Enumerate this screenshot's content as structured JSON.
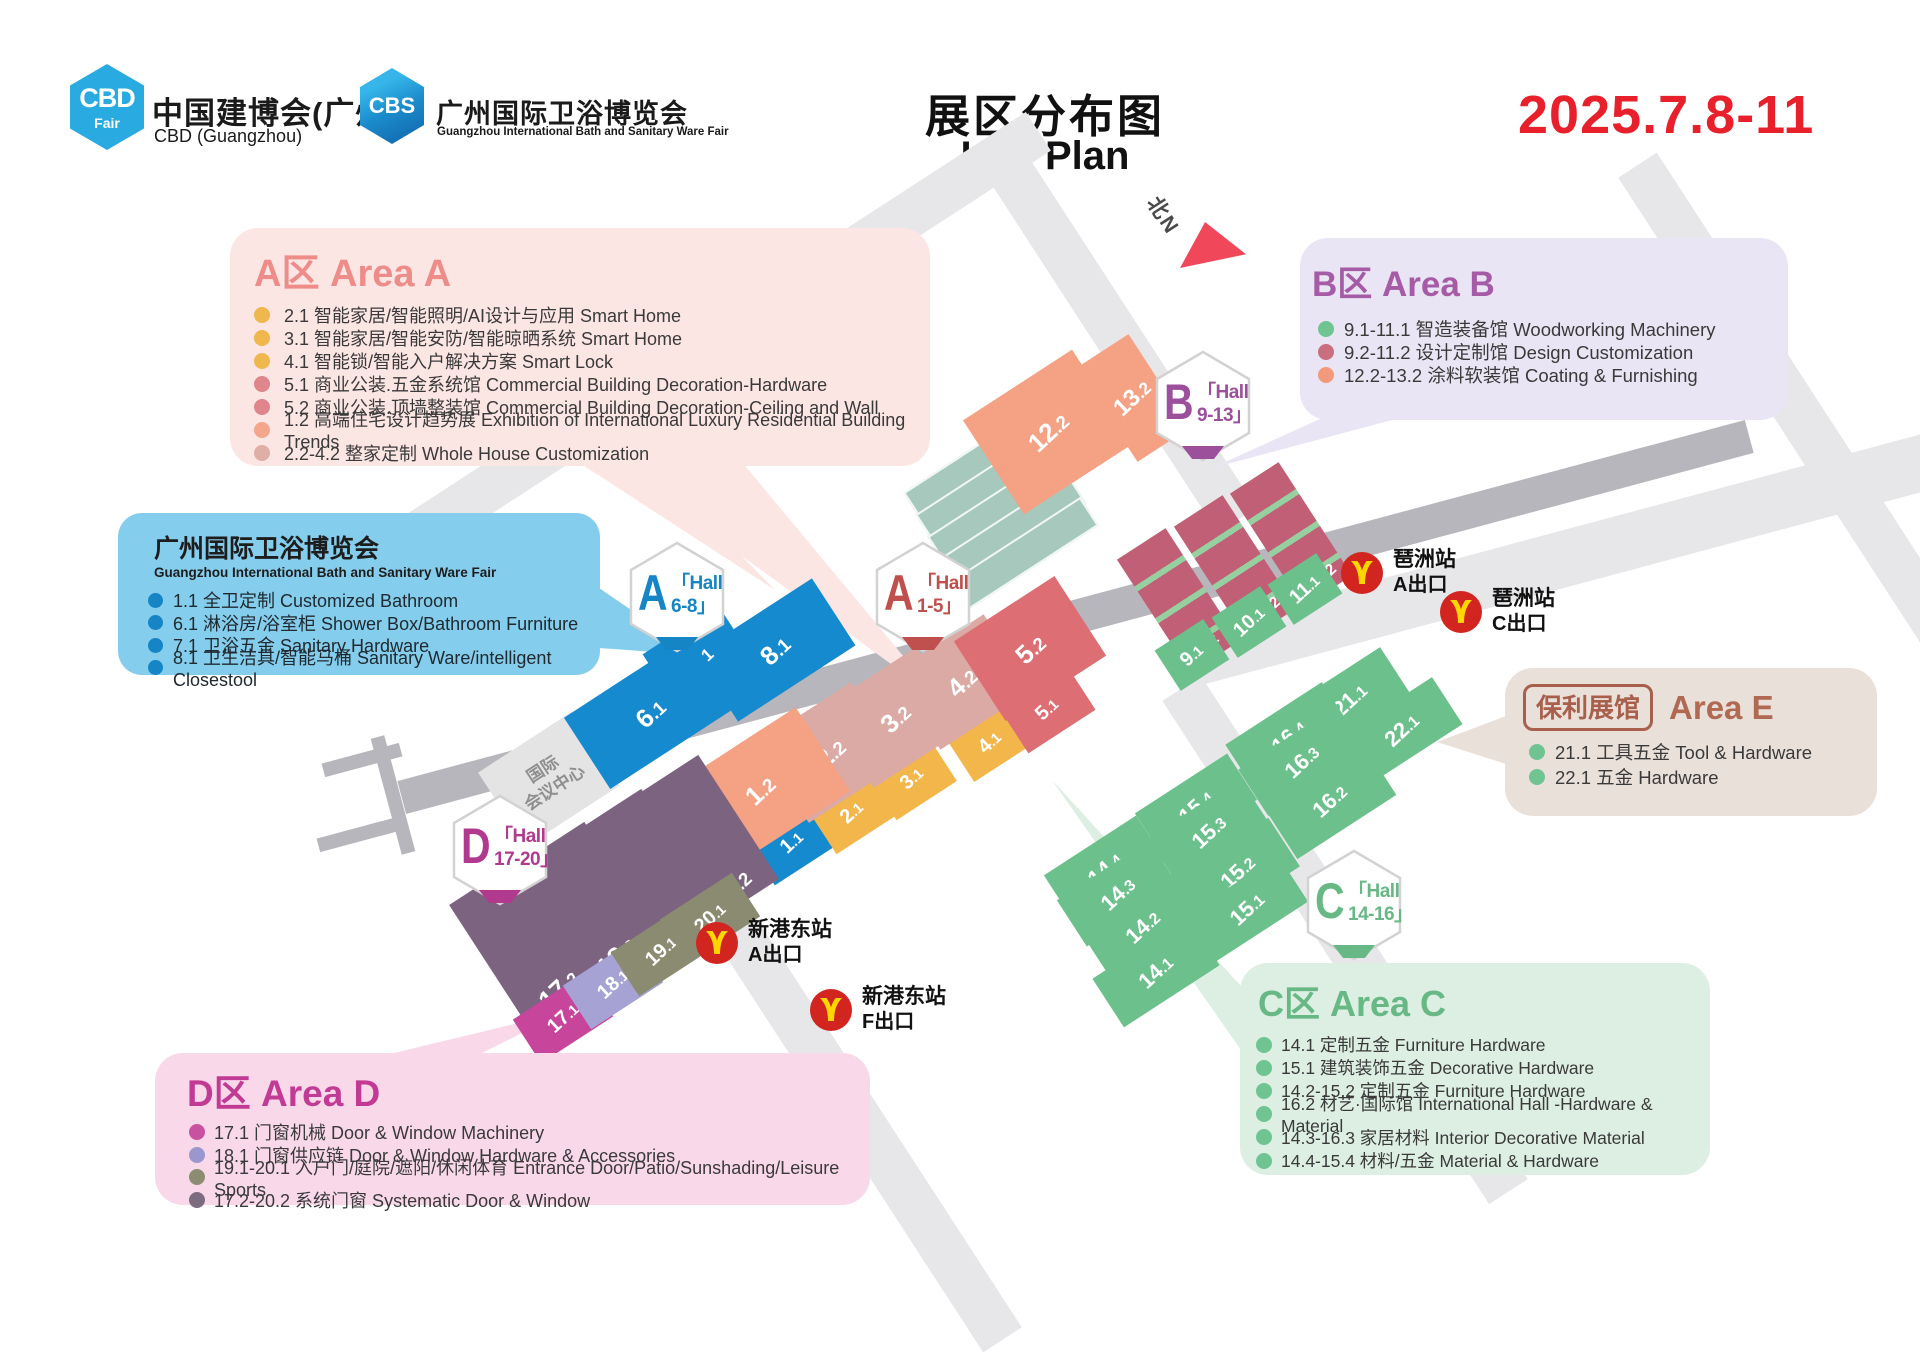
{
  "header": {
    "cbd_logo_text": "CBD",
    "cbd_logo_sub": "Fair",
    "cbd_name_cn": "中国建博会(广州)",
    "cbd_name_en": "CBD (Guangzhou)",
    "cbs_logo_text": "CBS",
    "cbs_name_cn": "广州国际卫浴博览会",
    "cbs_name_en": "Guangzhou International Bath and Sanitary Ware Fair",
    "title_cn": "展区分布图",
    "title_en": "Hall Plan",
    "dates": "2025.7.8-11",
    "dates_color": "#e8202c"
  },
  "legends": {
    "area_a": {
      "title": "A区 Area A",
      "accent": "#ee8c89",
      "bg": "#fbe6e4",
      "items": [
        {
          "dot": "#efb74e",
          "text": "2.1 智能家居/智能照明/AI设计与应用 Smart Home"
        },
        {
          "dot": "#efb74e",
          "text": "3.1 智能家居/智能安防/智能晾晒系统 Smart Home"
        },
        {
          "dot": "#efb74e",
          "text": "4.1 智能锁/智能入户解决方案 Smart Lock"
        },
        {
          "dot": "#e0858b",
          "text": "5.1 商业公装.五金系统馆 Commercial Building Decoration-Hardware"
        },
        {
          "dot": "#e0858b",
          "text": "5.2 商业公装.顶墙整装馆 Commercial Building Decoration-Ceiling and Wall"
        },
        {
          "dot": "#f4a68c",
          "text": "1.2 高端住宅设计趋势展 Exhibition of International Luxury Residential Building Trends"
        },
        {
          "dot": "#dfaea7",
          "text": "2.2-4.2 整家定制 Whole House Customization"
        }
      ]
    },
    "area_b": {
      "title": "B区 Area B",
      "accent": "#a55ba5",
      "bg": "#e9e5f4",
      "items": [
        {
          "dot": "#6fc492",
          "text": "9.1-11.1 智造装备馆 Woodworking Machinery"
        },
        {
          "dot": "#c96f7f",
          "text": "9.2-11.2 设计定制馆 Design Customization"
        },
        {
          "dot": "#f29a7b",
          "text": "12.2-13.2 涂料软装馆 Coating & Furnishing"
        }
      ]
    },
    "bath": {
      "title": "广州国际卫浴博览会",
      "subtitle": "Guangzhou International Bath and Sanitary Ware Fair",
      "accent": "#1585c5",
      "bg": "#85cdec",
      "items": [
        {
          "dot": "#1585c5",
          "text": "1.1 全卫定制 Customized Bathroom"
        },
        {
          "dot": "#1585c5",
          "text": "6.1 淋浴房/浴室柜 Shower Box/Bathroom Furniture"
        },
        {
          "dot": "#1585c5",
          "text": "7.1 卫浴五金 Sanitary Hardware"
        },
        {
          "dot": "#1585c5",
          "text": "8.1 卫生洁具/智能马桶 Sanitary Ware/intelligent Closestool"
        }
      ]
    },
    "area_e": {
      "badge": "保利展馆",
      "title": "Area E",
      "accent": "#b06a52",
      "bg": "#eae0da",
      "items": [
        {
          "dot": "#6fc492",
          "text": "21.1 工具五金 Tool & Hardware"
        },
        {
          "dot": "#6fc492",
          "text": "22.1 五金 Hardware"
        }
      ]
    },
    "area_c": {
      "title": "C区 Area C",
      "accent": "#68b886",
      "bg": "#ddeee3",
      "items": [
        {
          "dot": "#6fc492",
          "text": "14.1 定制五金 Furniture Hardware"
        },
        {
          "dot": "#6fc492",
          "text": "15.1 建筑装饰五金 Decorative Hardware"
        },
        {
          "dot": "#6fc492",
          "text": "14.2-15.2 定制五金 Furniture Hardware"
        },
        {
          "dot": "#6fc492",
          "text": "16.2 材艺·国际馆 International Hall -Hardware & Material"
        },
        {
          "dot": "#6fc492",
          "text": "14.3-16.3 家居材料 Interior Decorative Material"
        },
        {
          "dot": "#6fc492",
          "text": "14.4-15.4 材料/五金 Material & Hardware"
        }
      ]
    },
    "area_d": {
      "title": "D区 Area D",
      "accent": "#c13a94",
      "bg": "#f8d8e9",
      "items": [
        {
          "dot": "#c8529f",
          "text": "17.1 门窗机械  Door & Window Machinery"
        },
        {
          "dot": "#9a97ce",
          "text": "18.1 门窗供应链  Door & Window Hardware & Accessories"
        },
        {
          "dot": "#8c8c72",
          "text": "19.1-20.1 入户门/庭院/遮阳/休闲体育 Entrance Door/Patio/Sunshading/Leisure Sports"
        },
        {
          "dot": "#7b6c80",
          "text": "17.2-20.2 系统门窗 Systematic Door & Window"
        }
      ]
    }
  },
  "map": {
    "north_label": "北N",
    "landmark": {
      "line1": "国际",
      "line2": "会议中心"
    },
    "roads": [
      {
        "x": 165,
        "y": 367,
        "w": 950,
        "h": 46,
        "r": -33,
        "c": "#e7e7e9"
      },
      {
        "x": 1097,
        "y": 125,
        "w": 46,
        "h": 430,
        "r": -33,
        "c": "#e7e7e9"
      },
      {
        "x": 1767,
        "y": 120,
        "w": 46,
        "h": 560,
        "r": -33,
        "c": "#e7e7e9"
      },
      {
        "x": 1322,
        "y": 640,
        "w": 46,
        "h": 600,
        "r": -33,
        "c": "#e7e7e9"
      },
      {
        "x": 827,
        "y": 825,
        "w": 46,
        "h": 560,
        "r": -33,
        "c": "#e7e7e9"
      },
      {
        "x": 1180,
        "y": 532,
        "w": 760,
        "h": 56,
        "r": -15,
        "c": "#e7e7e9"
      },
      {
        "x": 378,
        "y": 600,
        "w": 1395,
        "h": 34,
        "r": -15,
        "c": "#b6b6bc"
      },
      {
        "x": 386,
        "y": 735,
        "w": 14,
        "h": 120,
        "r": -15,
        "c": "#b6b6bc"
      },
      {
        "x": 322,
        "y": 753,
        "w": 80,
        "h": 14,
        "r": -15,
        "c": "#b6b6bc"
      },
      {
        "x": 317,
        "y": 828,
        "w": 80,
        "h": 14,
        "r": -15,
        "c": "#b6b6bc"
      }
    ],
    "plates": [
      {
        "x": 900,
        "y": 448
      },
      {
        "x": 912,
        "y": 470
      },
      {
        "x": 924,
        "y": 492
      },
      {
        "x": 936,
        "y": 514
      },
      {
        "x": 948,
        "y": 536
      }
    ],
    "tails": [
      {
        "points": "612,462 742,462 938,698",
        "c": "#fbe6e4"
      },
      {
        "points": "578,462 650,462 775,590",
        "c": "#fbe6e4"
      },
      {
        "points": "599,588 599,648 697,655",
        "c": "#85cdec"
      },
      {
        "points": "1320,419 1396,419 1212,468",
        "c": "#e9e5f4"
      },
      {
        "points": "1506,716 1506,764 1437,742",
        "c": "#eae0da"
      },
      {
        "points": "1241,1050 1241,986 1052,780",
        "c": "#ddeee3"
      },
      {
        "points": "390,1054 480,1054 564,1012",
        "c": "#f8d8e9"
      }
    ],
    "halls": [
      {
        "l": "8.1",
        "x": 775,
        "y": 650,
        "w": 140,
        "h": 80,
        "c": "#168acf",
        "fs": 26
      },
      {
        "l": "7.1",
        "x": 700,
        "y": 660,
        "w": 90,
        "h": 72,
        "c": "#168acf",
        "fs": 24
      },
      {
        "l": "6.1",
        "x": 650,
        "y": 712,
        "w": 150,
        "h": 85,
        "c": "#168acf",
        "fs": 26
      },
      {
        "l": "1.1",
        "x": 792,
        "y": 842,
        "w": 76,
        "h": 54,
        "c": "#168acf",
        "fs": 20
      },
      {
        "l": "2.1",
        "x": 852,
        "y": 812,
        "w": 72,
        "h": 54,
        "c": "#f3b64b",
        "fs": 20
      },
      {
        "l": "3.1",
        "x": 912,
        "y": 778,
        "w": 72,
        "h": 54,
        "c": "#f3b64b",
        "fs": 20
      },
      {
        "l": "4.1",
        "x": 990,
        "y": 742,
        "w": 70,
        "h": 50,
        "c": "#f3b64b",
        "fs": 20
      },
      {
        "l": "2.2",
        "x": 830,
        "y": 752,
        "w": 112,
        "h": 95,
        "c": "#dcaaa4",
        "fs": 26
      },
      {
        "l": "3.2",
        "x": 895,
        "y": 717,
        "w": 112,
        "h": 95,
        "c": "#dcaaa4",
        "fs": 26
      },
      {
        "l": "4.2",
        "x": 962,
        "y": 682,
        "w": 110,
        "h": 90,
        "c": "#dcaaa4",
        "fs": 26
      },
      {
        "l": "1.2",
        "x": 760,
        "y": 790,
        "w": 150,
        "h": 100,
        "c": "#f5a183",
        "fs": 26
      },
      {
        "l": "12.2",
        "x": 1048,
        "y": 432,
        "w": 130,
        "h": 112,
        "c": "#f5a183",
        "fs": 26
      },
      {
        "l": "13.2",
        "x": 1133,
        "y": 398,
        "w": 62,
        "h": 112,
        "c": "#f5a183",
        "fs": 24
      },
      {
        "l": "5.2",
        "x": 1030,
        "y": 648,
        "w": 120,
        "h": 95,
        "c": "#dd6e74",
        "fs": 26
      },
      {
        "l": "5.1",
        "x": 1047,
        "y": 708,
        "w": 80,
        "h": 55,
        "c": "#dd6e74",
        "fs": 20
      },
      {
        "l": "9.2",
        "x": 1178,
        "y": 600,
        "w": 58,
        "h": 135,
        "c": "#c05f75",
        "fs": 22,
        "bottom": true,
        "stripes": true
      },
      {
        "l": "10.2",
        "x": 1235,
        "y": 567,
        "w": 58,
        "h": 135,
        "c": "#c05f75",
        "fs": 22,
        "bottom": true,
        "stripes": true
      },
      {
        "l": "11.2",
        "x": 1291,
        "y": 534,
        "w": 58,
        "h": 135,
        "c": "#c05f75",
        "fs": 22,
        "bottom": true,
        "stripes": true
      },
      {
        "l": "9.1",
        "x": 1192,
        "y": 655,
        "w": 58,
        "h": 48,
        "c": "#6cc08b",
        "fs": 20
      },
      {
        "l": "10.1",
        "x": 1249,
        "y": 622,
        "w": 58,
        "h": 48,
        "c": "#6cc08b",
        "fs": 20
      },
      {
        "l": "11.1",
        "x": 1305,
        "y": 589,
        "w": 58,
        "h": 48,
        "c": "#6cc08b",
        "fs": 20
      },
      {
        "l": "21.1",
        "x": 1350,
        "y": 700,
        "w": 108,
        "h": 56,
        "c": "#6cc08b",
        "fs": 22
      },
      {
        "l": "22.1",
        "x": 1402,
        "y": 730,
        "w": 108,
        "h": 56,
        "c": "#6cc08b",
        "fs": 22
      },
      {
        "l": "16.4",
        "x": 1288,
        "y": 736,
        "w": 115,
        "h": 55,
        "c": "#6cc08b",
        "fs": 22
      },
      {
        "l": "16.3",
        "x": 1301,
        "y": 761,
        "w": 115,
        "h": 55,
        "c": "#6cc08b",
        "fs": 22
      },
      {
        "l": "16.2",
        "x": 1330,
        "y": 801,
        "w": 118,
        "h": 62,
        "c": "#6cc08b",
        "fs": 22
      },
      {
        "l": "15.4",
        "x": 1196,
        "y": 806,
        "w": 110,
        "h": 55,
        "c": "#6cc08b",
        "fs": 22
      },
      {
        "l": "15.3",
        "x": 1209,
        "y": 831,
        "w": 110,
        "h": 55,
        "c": "#6cc08b",
        "fs": 22
      },
      {
        "l": "15.2",
        "x": 1238,
        "y": 872,
        "w": 110,
        "h": 58,
        "c": "#6cc08b",
        "fs": 22
      },
      {
        "l": "15.1",
        "x": 1247,
        "y": 908,
        "w": 110,
        "h": 55,
        "c": "#6cc08b",
        "fs": 22
      },
      {
        "l": "14.4",
        "x": 1105,
        "y": 868,
        "w": 110,
        "h": 55,
        "c": "#6cc08b",
        "fs": 22
      },
      {
        "l": "14.3",
        "x": 1118,
        "y": 893,
        "w": 110,
        "h": 55,
        "c": "#6cc08b",
        "fs": 22
      },
      {
        "l": "14.2",
        "x": 1143,
        "y": 927,
        "w": 110,
        "h": 58,
        "c": "#6cc08b",
        "fs": 22
      },
      {
        "l": "14.1",
        "x": 1156,
        "y": 972,
        "w": 114,
        "h": 58,
        "c": "#6cc08b",
        "fs": 22
      },
      {
        "l": "17.2",
        "x": 528,
        "y": 942,
        "w": 92,
        "h": 148,
        "c": "#7c6480",
        "fs": 26,
        "bottom": true
      },
      {
        "l": "18.2",
        "x": 586,
        "y": 909,
        "w": 92,
        "h": 148,
        "c": "#7c6480",
        "fs": 26,
        "bottom": true
      },
      {
        "l": "19.2",
        "x": 643,
        "y": 876,
        "w": 92,
        "h": 148,
        "c": "#7c6480",
        "fs": 26,
        "bottom": true
      },
      {
        "l": "20.2",
        "x": 700,
        "y": 842,
        "w": 92,
        "h": 148,
        "c": "#7c6480",
        "fs": 26,
        "bottom": true
      },
      {
        "l": "17.1",
        "x": 563,
        "y": 1018,
        "w": 86,
        "h": 52,
        "c": "#c8459c",
        "fs": 20
      },
      {
        "l": "18.1",
        "x": 613,
        "y": 984,
        "w": 86,
        "h": 52,
        "c": "#a6a2d4",
        "fs": 20
      },
      {
        "l": "19.1",
        "x": 661,
        "y": 951,
        "w": 86,
        "h": 52,
        "c": "#8b8b71",
        "fs": 20
      },
      {
        "l": "20.1",
        "x": 710,
        "y": 918,
        "w": 86,
        "h": 52,
        "c": "#8b8b71",
        "fs": 20
      }
    ],
    "badges": [
      {
        "letter": "A",
        "line1": "「Hall",
        "line2": "6-8」",
        "c": "#1585c5",
        "x": 677,
        "y": 597
      },
      {
        "letter": "A",
        "line1": "「Hall",
        "line2": "1-5」",
        "c": "#c0504d",
        "x": 923,
        "y": 597
      },
      {
        "letter": "B",
        "line1": "「Hall",
        "line2": "9-13」",
        "c": "#9c4f9b",
        "x": 1203,
        "y": 406
      },
      {
        "letter": "C",
        "line1": "「Hall",
        "line2": "14-16」",
        "c": "#68b886",
        "x": 1354,
        "y": 905
      },
      {
        "letter": "D",
        "line1": "「Hall",
        "line2": "17-20」",
        "c": "#b13a8e",
        "x": 500,
        "y": 850
      }
    ],
    "stations": [
      {
        "name": "琶洲站",
        "exit": "A出口",
        "x": 1362,
        "y": 573
      },
      {
        "name": "琶洲站",
        "exit": "C出口",
        "x": 1461,
        "y": 612
      },
      {
        "name": "新港东站",
        "exit": "A出口",
        "x": 717,
        "y": 943
      },
      {
        "name": "新港东站",
        "exit": "F出口",
        "x": 831,
        "y": 1010
      }
    ],
    "metro_red": "#d2251f",
    "metro_yellow": "#ffd600"
  }
}
